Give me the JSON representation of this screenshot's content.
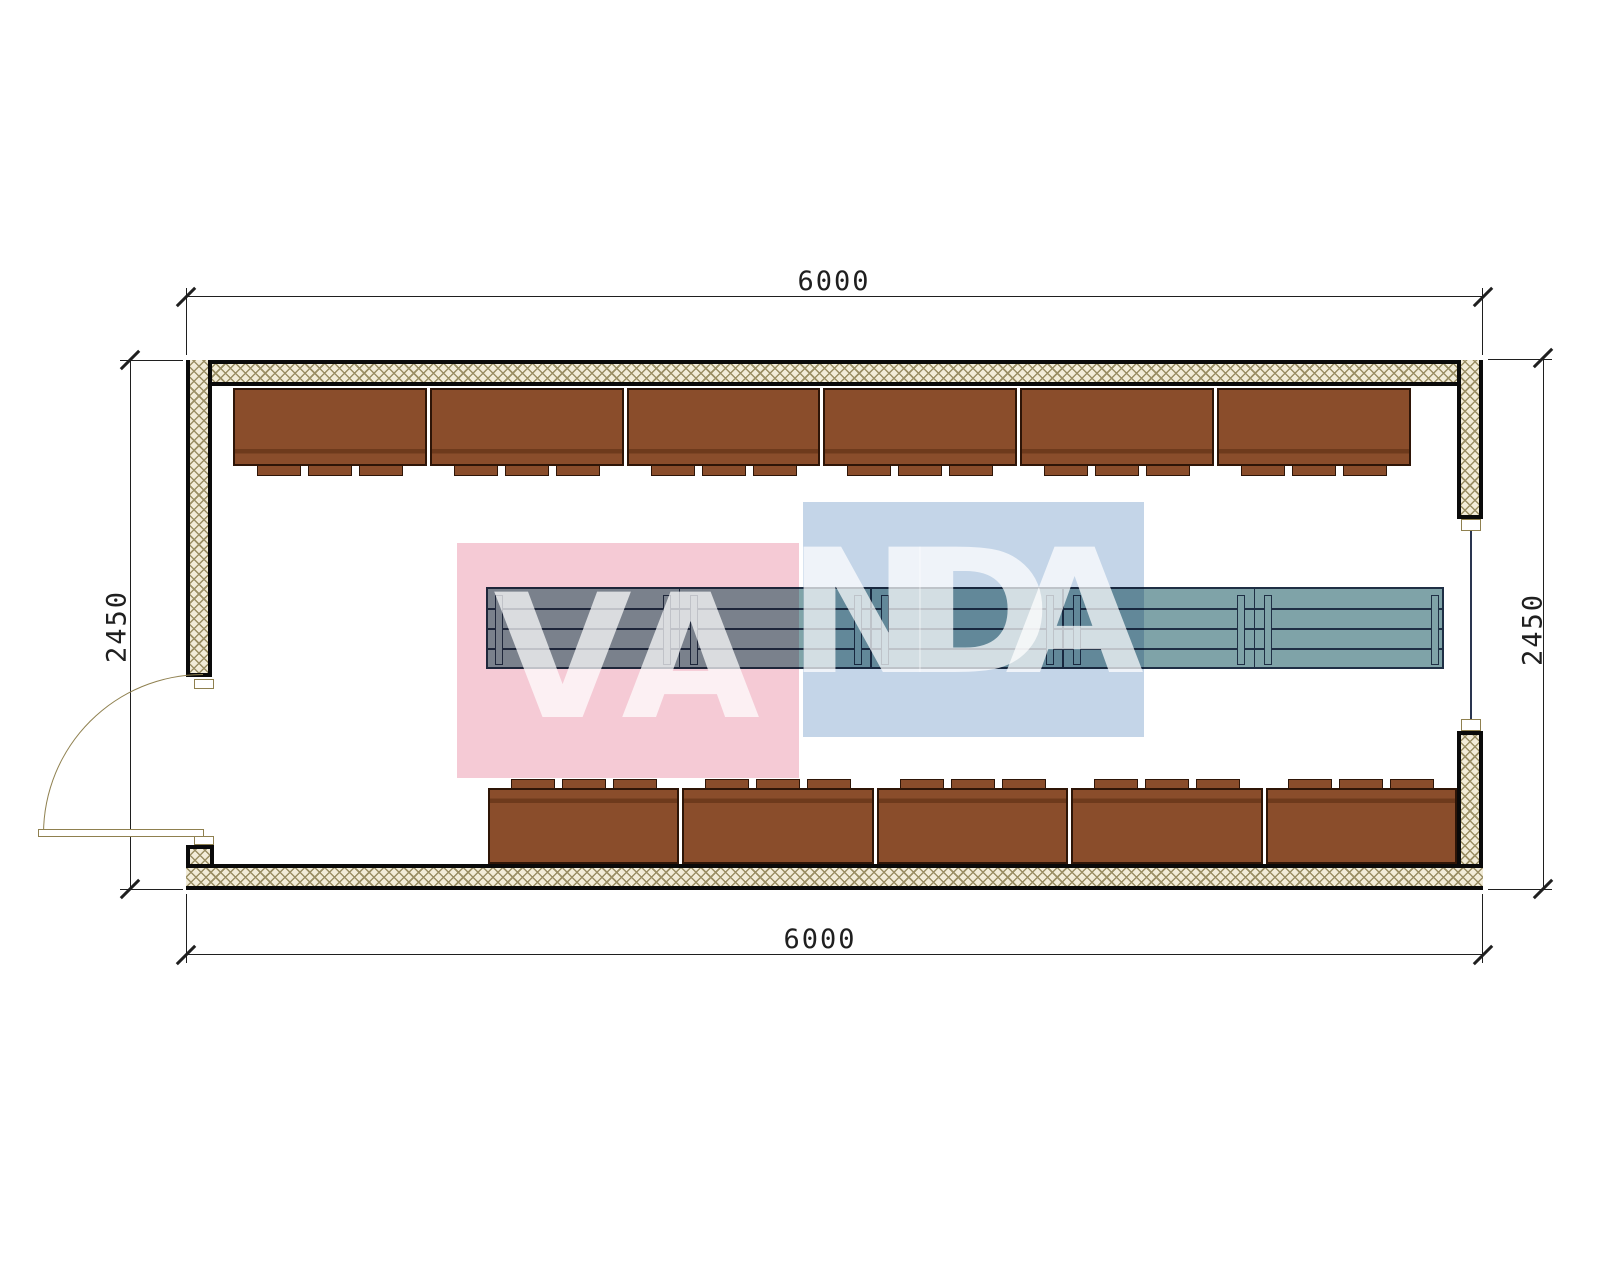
{
  "title": "room-floor-plan",
  "dimensions": {
    "top": "6000",
    "bottom": "6000",
    "left": "2450",
    "right": "2450"
  },
  "watermark": {
    "text": "VANDA",
    "pink_square_color": "#f5cad5",
    "blue_square_color": "#c4d5e8",
    "letter_color": "rgba(255,255,255,0.72)"
  },
  "palette": {
    "wall_hatch_bg": "#f2ecd8",
    "wall_hatch_line": "#9a8e64",
    "wall_edge": "#0a0a0a",
    "seat_fill": "#8a4d2b",
    "seat_edge": "#2e1507",
    "table_fill": "#7fa3a8",
    "table_edge": "#1f2f45",
    "door_color": "#8f804f",
    "window_color": "#2a3550",
    "dimension_color": "#1f1f1f"
  },
  "furniture": {
    "top_row_units": 6,
    "top_row_tabs_per_unit": 3,
    "bottom_row_units": 5,
    "bottom_row_tabs_per_unit": 3,
    "table_sections": 5
  }
}
